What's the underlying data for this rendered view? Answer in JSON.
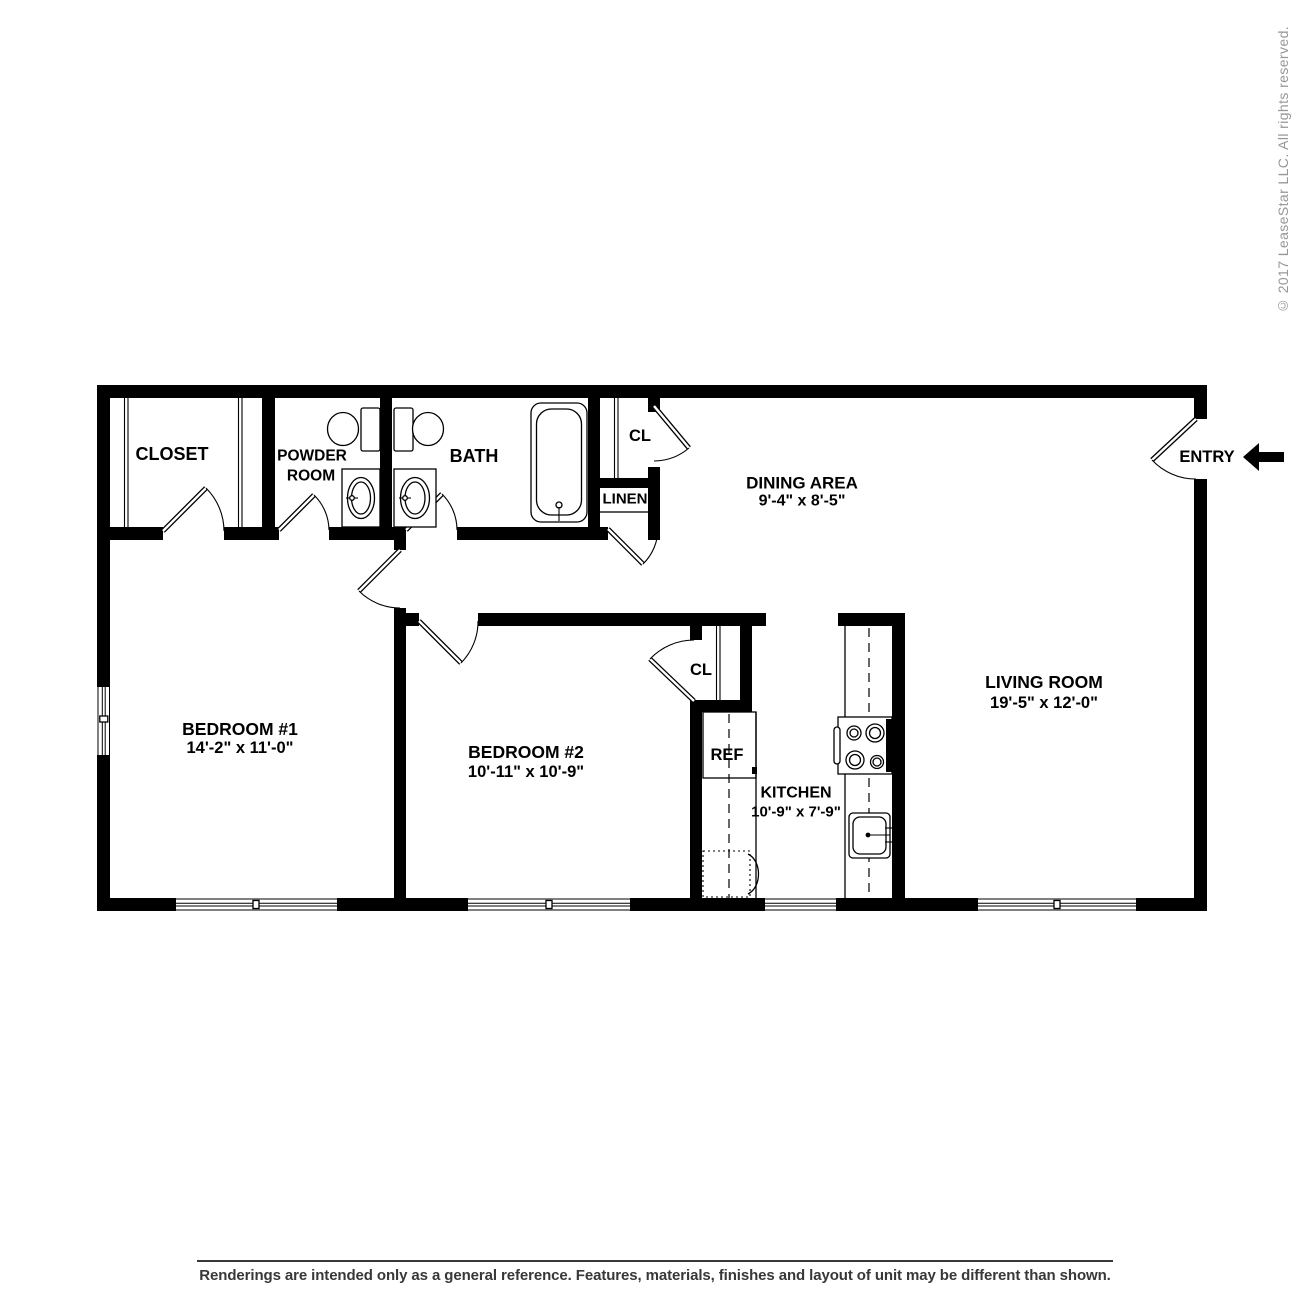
{
  "rooms": {
    "closet": {
      "label": "CLOSET"
    },
    "powder_room": {
      "label_line1": "POWDER",
      "label_line2": "ROOM"
    },
    "bath": {
      "label": "BATH"
    },
    "hall_closet": {
      "label": "CL"
    },
    "linen": {
      "label": "LINEN"
    },
    "dining_area": {
      "label": "DINING AREA",
      "dimensions": "9'-4\" x 8'-5\""
    },
    "entry": {
      "label": "ENTRY"
    },
    "bedroom_1": {
      "label": "BEDROOM #1",
      "dimensions": "14'-2\" x 11'-0\""
    },
    "bedroom_2": {
      "label": "BEDROOM #2",
      "dimensions": "10'-11\" x 10'-9\""
    },
    "bedroom_2_closet": {
      "label": "CL"
    },
    "refrigerator": {
      "label": "REF"
    },
    "kitchen": {
      "label": "KITCHEN",
      "dimensions": "10'-9\" x 7'-9\""
    },
    "living_room": {
      "label": "LIVING ROOM",
      "dimensions": "19'-5\" x 12'-0\""
    }
  },
  "watermark": {
    "copyright": "© 2017 LeaseStar LLC. All rights reserved."
  },
  "footer": {
    "disclaimer": "Renderings are intended only as a general reference. Features, materials, finishes and layout of unit may be different than shown."
  },
  "colors": {
    "wall": "#000000",
    "copyright_text": "#979797",
    "disclaimer_text": "#383838",
    "background": "#ffffff"
  },
  "icons": {
    "toilet": "toilet-icon",
    "sink": "sink-icon",
    "bathtub": "bathtub-icon",
    "stove": "stove-icon",
    "kitchen_sink": "kitchen-sink-icon",
    "dishwasher": "dishwasher-icon",
    "window": "window-icon",
    "door_swing": "door-swing-icon",
    "entry_arrow": "left-arrow-icon"
  }
}
